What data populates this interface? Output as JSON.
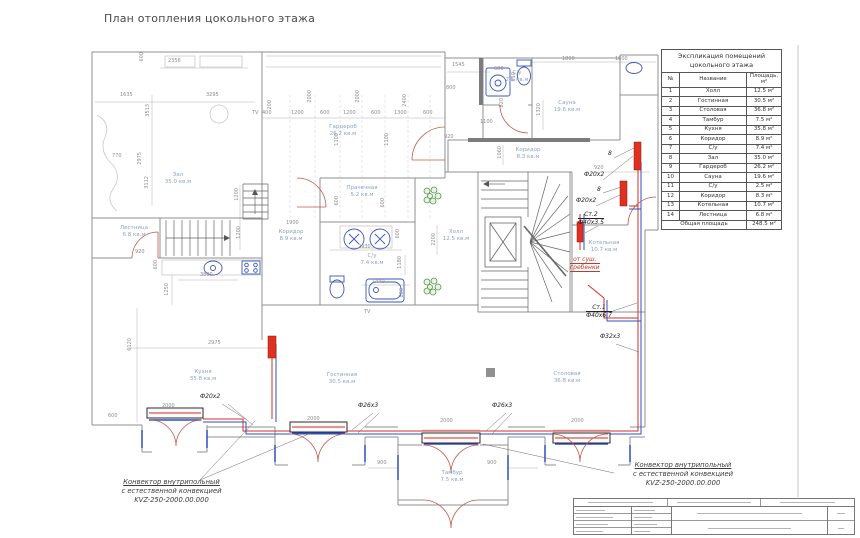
{
  "title": "План отопления цокольного этажа",
  "schedule": {
    "title1": "Экспликация  помещений",
    "title2": "цокольного  этажа",
    "col_num": "№",
    "col_name": "Название",
    "col_area": "Площадь, м²",
    "rows": [
      {
        "n": "1",
        "name": "Холл",
        "area": "12.5 м²"
      },
      {
        "n": "2",
        "name": "Гостинная",
        "area": "30.5 м²"
      },
      {
        "n": "3",
        "name": "Столовая",
        "area": "36.8 м²"
      },
      {
        "n": "4",
        "name": "Тамбур",
        "area": "7.5 м²"
      },
      {
        "n": "5",
        "name": "Кухня",
        "area": "35.8 м²"
      },
      {
        "n": "6",
        "name": "Коридор",
        "area": "8.9 м²"
      },
      {
        "n": "7",
        "name": "С/у",
        "area": "7.4 м²"
      },
      {
        "n": "8",
        "name": "Зал",
        "area": "35.0 м²"
      },
      {
        "n": "9",
        "name": "Гардероб",
        "area": "26.2 м²"
      },
      {
        "n": "10",
        "name": "Сауна",
        "area": "19.6 м²"
      },
      {
        "n": "11",
        "name": "С/у",
        "area": "2.5 м²"
      },
      {
        "n": "12",
        "name": "Коридор",
        "area": "8.3 м²"
      },
      {
        "n": "13",
        "name": "Котельная",
        "area": "10.7 м²"
      },
      {
        "n": "14",
        "name": "Лестница",
        "area": "6.8 м²"
      }
    ],
    "total_label": "Общая площадь",
    "total_value": "248.5 м²"
  },
  "rooms": {
    "zal": {
      "name": "Зал",
      "area": "35.0 кв.м"
    },
    "garderob": {
      "name": "Гардероб",
      "area": "26.2 кв.м"
    },
    "prachechnaya": {
      "name": "Прачечная",
      "area": "5.2 кв.м"
    },
    "koridor1": {
      "name": "Коридор",
      "area": "8.9 кв.м"
    },
    "su1": {
      "name": "С/у",
      "area": "7.4 кв.м"
    },
    "kholl": {
      "name": "Холл",
      "area": "12.5 кв.м"
    },
    "lestnitsa": {
      "name": "Лестница",
      "area": "6.8 кв.м"
    },
    "su2": {
      "name": "С/у",
      "area": "2.5 кв.м"
    },
    "sauna": {
      "name": "Сауна",
      "area": "19.6 кв.м"
    },
    "koridor2": {
      "name": "Коридор",
      "area": "8.3 кв.м"
    },
    "kotelnaya": {
      "name": "Котельная",
      "area": "10.7 кв.м"
    },
    "kukhnya": {
      "name": "Кухня",
      "area": "35.8 кв.м"
    },
    "gostinaya": {
      "name": "Гостинная",
      "area": "30.5 кв.м"
    },
    "stolovaya": {
      "name": "Столовая",
      "area": "36.8 кв.м"
    },
    "tambur": {
      "name": "Тамбур",
      "area": "7.5 кв.м"
    }
  },
  "pipes": {
    "f20": "Ф20х2",
    "f26": "Ф26х3",
    "f32": "Ф32х3",
    "st1": "Ст.1",
    "st1_size": "Ф40х6.7",
    "st2": "Ст.2",
    "st2_size": "Ф40х3.5",
    "dry1": "от суш.",
    "dry2": "гребенки",
    "riser_mark": "8"
  },
  "annotations": {
    "conv1": "Конвектор внутрипольный",
    "conv2": "с естественной конвекцией",
    "conv3": "KVZ-250-2000.00.000"
  },
  "misc": {
    "tv": "TV"
  },
  "dims": {
    "v200": "200",
    "v400": "400",
    "v600": "600",
    "v770": "770",
    "v800": "800",
    "v810": "810",
    "v820": "820",
    "v900": "900",
    "v920": "920",
    "v1060": "1060",
    "v1100": "1100",
    "v1180": "1180",
    "v1200": "1200",
    "v1250": "1250",
    "v1300": "1300",
    "v1320": "1320",
    "v1440": "1440",
    "v1545": "1545",
    "v1635": "1635",
    "v1800": "1800",
    "v1900": "1900",
    "v2000": "2000",
    "v2200": "2200",
    "v2356": "2356",
    "v2400": "2400",
    "v2930": "2930",
    "v2975": "2975",
    "v3112": "3112",
    "v3295": "3295",
    "v3513": "3513",
    "v3800": "3800",
    "v6120": "6120"
  }
}
